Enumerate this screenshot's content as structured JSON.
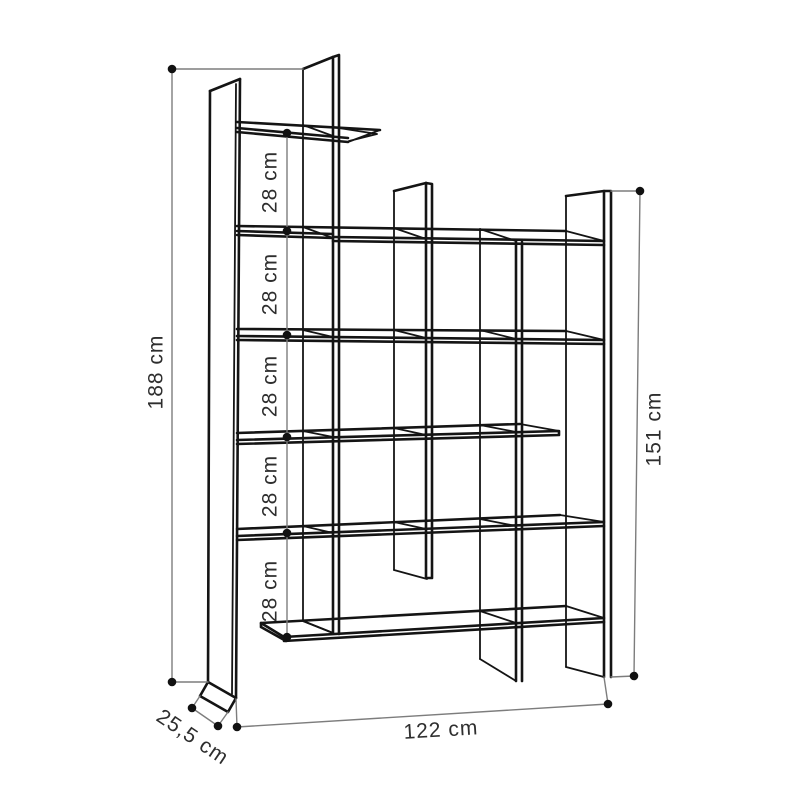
{
  "dimensions": {
    "total_height": "188 cm",
    "right_section_height": "151 cm",
    "width": "122 cm",
    "depth": "25,5 cm",
    "shelf_gaps": [
      "28 cm",
      "28 cm",
      "28 cm",
      "28 cm",
      "28 cm"
    ]
  }
}
